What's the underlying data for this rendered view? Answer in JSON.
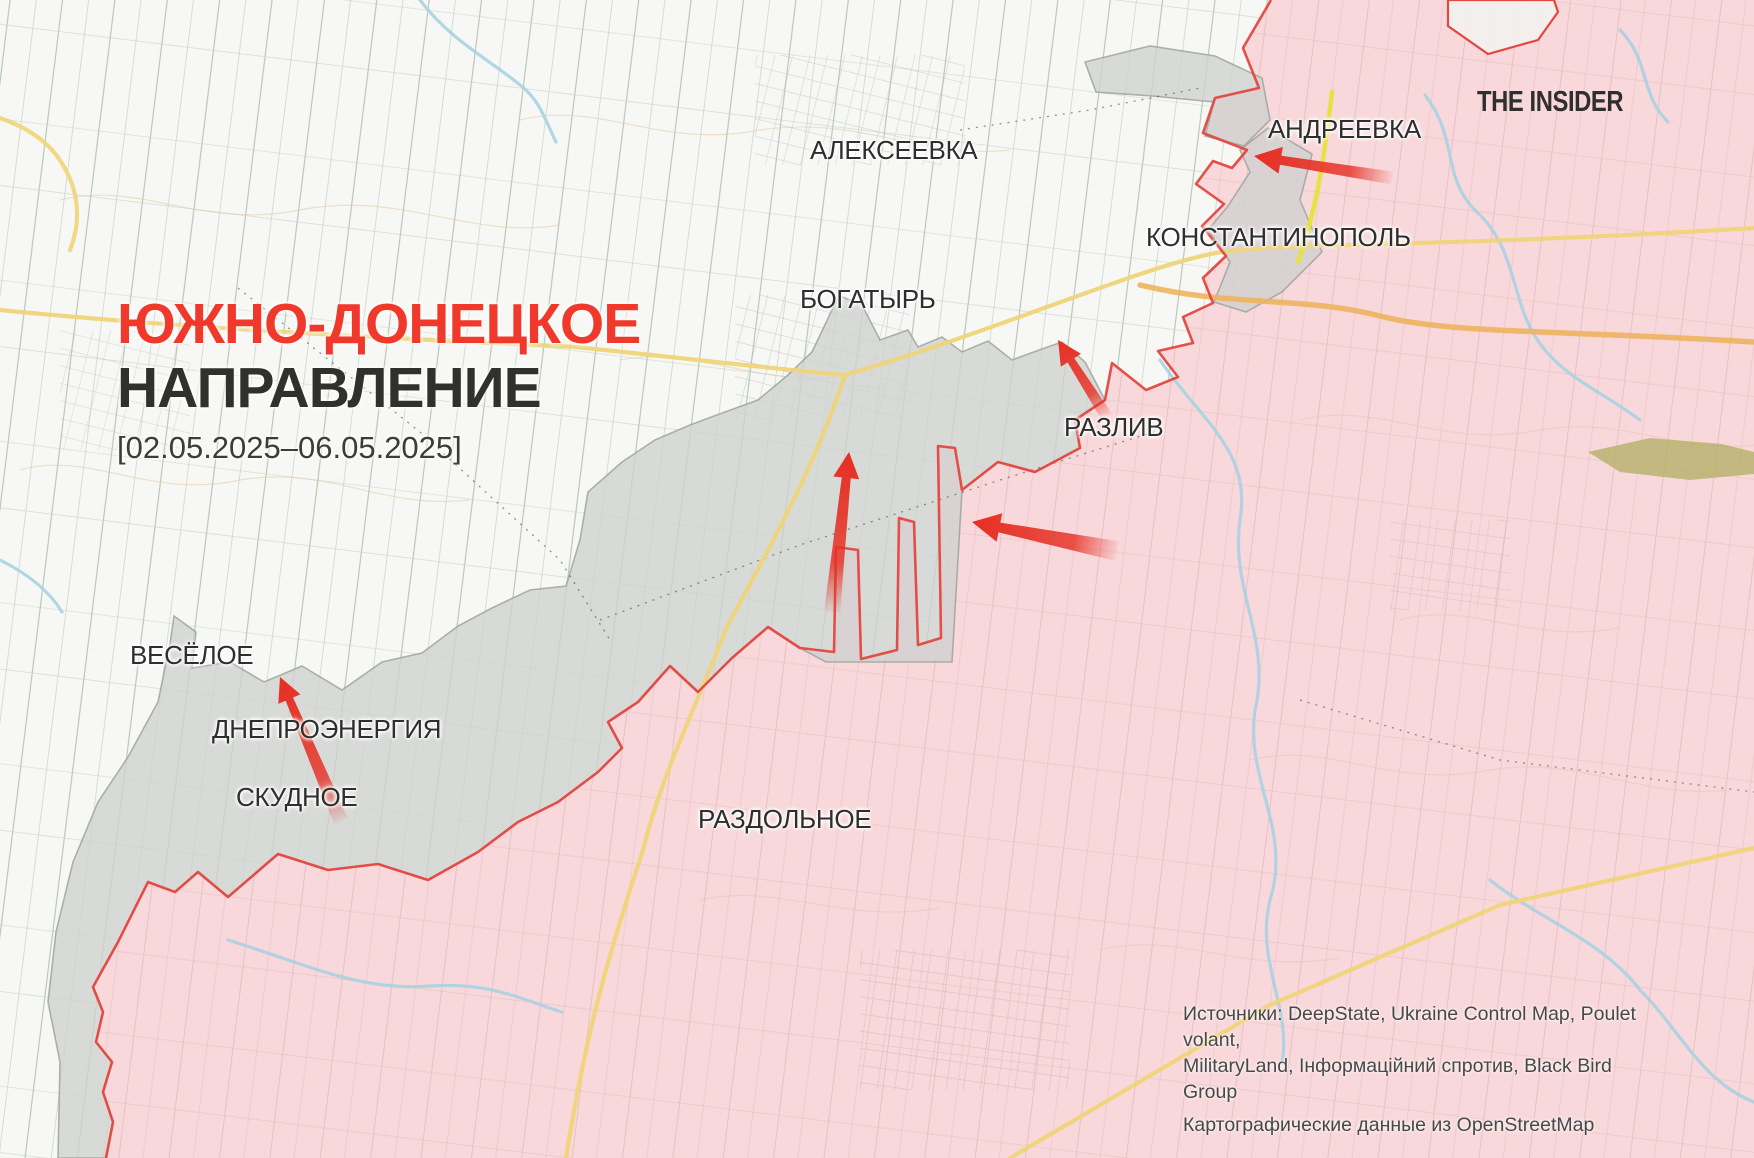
{
  "title": {
    "line1": "ЮЖНО-ДОНЕЦКОЕ",
    "line2": "НАПРАВЛЕНИЕ",
    "dates": "[02.05.2025–06.05.2025]"
  },
  "brand": {
    "logo_text": "THE INSIDER"
  },
  "towns": [
    {
      "id": "alekseevka",
      "name": "АЛЕКСЕЕВКА",
      "x": 810,
      "y": 135
    },
    {
      "id": "andreevka",
      "name": "АНДРЕЕВКА",
      "x": 1268,
      "y": 114
    },
    {
      "id": "konstantinopol",
      "name": "КОНСТАНТИНОПОЛЬ",
      "x": 1146,
      "y": 222
    },
    {
      "id": "bogatyr",
      "name": "БОГАТЫРЬ",
      "x": 800,
      "y": 284
    },
    {
      "id": "razliv",
      "name": "РАЗЛИВ",
      "x": 1064,
      "y": 412
    },
    {
      "id": "vesyoloe",
      "name": "ВЕСЁЛОЕ",
      "x": 130,
      "y": 640
    },
    {
      "id": "dneproenergia",
      "name": "ДНЕПРОЭНЕРГИЯ",
      "x": 212,
      "y": 714
    },
    {
      "id": "skudnoe",
      "name": "СКУДНОЕ",
      "x": 236,
      "y": 782
    },
    {
      "id": "razdolnoe",
      "name": "РАЗДОЛЬНОЕ",
      "x": 698,
      "y": 804
    }
  ],
  "arrows": [
    {
      "id": "andreevka-west",
      "from": [
        1392,
        178
      ],
      "to": [
        1254,
        156
      ],
      "tailW": 13,
      "tipW": 9,
      "headW": 27,
      "headL": 27
    },
    {
      "id": "razliv-north",
      "from": [
        1107,
        417
      ],
      "to": [
        1058,
        340
      ],
      "tailW": 12,
      "tipW": 8,
      "headW": 24,
      "headL": 24
    },
    {
      "id": "center-north",
      "from": [
        832,
        612
      ],
      "to": [
        849,
        452
      ],
      "tailW": 16,
      "tipW": 9,
      "headW": 26,
      "headL": 26
    },
    {
      "id": "center-west",
      "from": [
        1117,
        551
      ],
      "to": [
        972,
        522
      ],
      "tailW": 20,
      "tipW": 10,
      "headW": 29,
      "headL": 28
    },
    {
      "id": "skudnoe-north",
      "from": [
        341,
        821
      ],
      "to": [
        280,
        677
      ],
      "tailW": 15,
      "tipW": 8,
      "headW": 24,
      "headL": 24
    }
  ],
  "sources": {
    "line1": "Источники: DeepState, Ukraine Control Map, Poulet volant,",
    "line2": "MilitaryLand, Інформаційний спротив, Black Bird Group",
    "line3": "Картографические данные из OpenStreetMap"
  },
  "legend_colors": {
    "occupied_fill": "#f8d8da",
    "contested_fill": "#cfd2cf",
    "frontline": "#e4473f",
    "attack_arrow": "#e62e22",
    "title_accent": "#f0382b",
    "road_yellow": "#f0d479",
    "road_orange": "#edb45e",
    "river_blue": "#a9d1e2"
  }
}
